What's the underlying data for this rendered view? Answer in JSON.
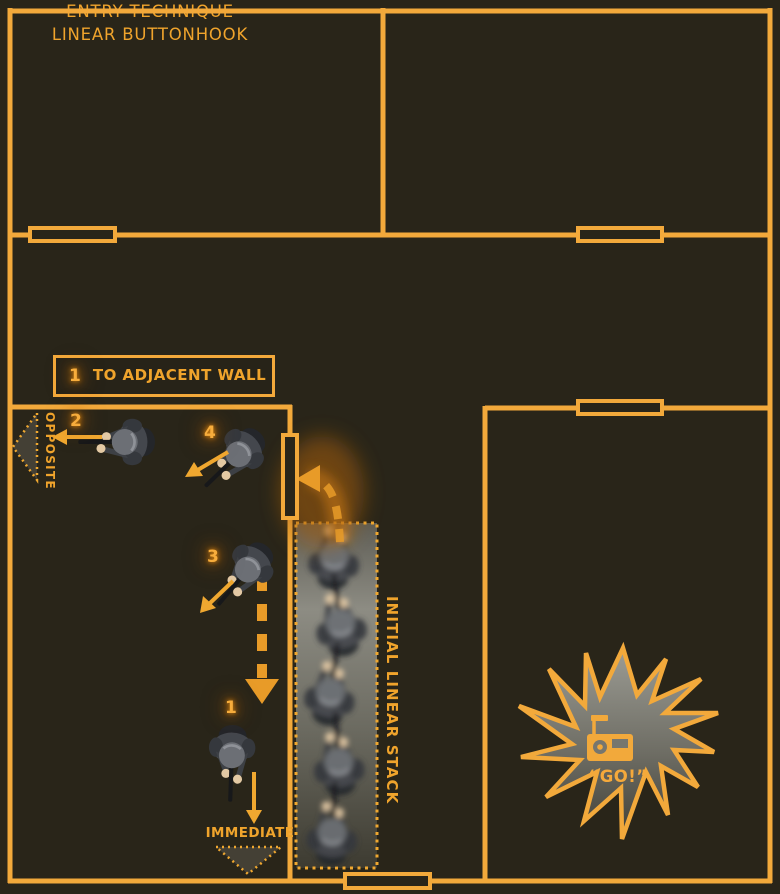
{
  "title": {
    "line1": "ENTRY TECHNIQUE",
    "line2": "LINEAR BUTTONHOOK"
  },
  "legend": {
    "number": "1",
    "label": "TO ADJACENT WALL"
  },
  "annotations": {
    "opposite": "OPPOSITE",
    "immediate": "IMMEDIATE",
    "initial_stack": "INITIAL LINEAR STACK",
    "go_callout": "“GO!”"
  },
  "operators": [
    {
      "number": "1",
      "movement": "south-immediate"
    },
    {
      "number": "2",
      "movement": "west-opposite"
    },
    {
      "number": "3",
      "movement": "southwest"
    },
    {
      "number": "4",
      "movement": "southwest"
    }
  ],
  "icons": {
    "radio": "radio-icon"
  },
  "colors": {
    "background": "#292519",
    "wall": "#F2A93B",
    "text": "#F0A42C",
    "glow": "#D97E0C",
    "burst_top": "#9C9C94",
    "burst_bottom": "#403F37"
  }
}
